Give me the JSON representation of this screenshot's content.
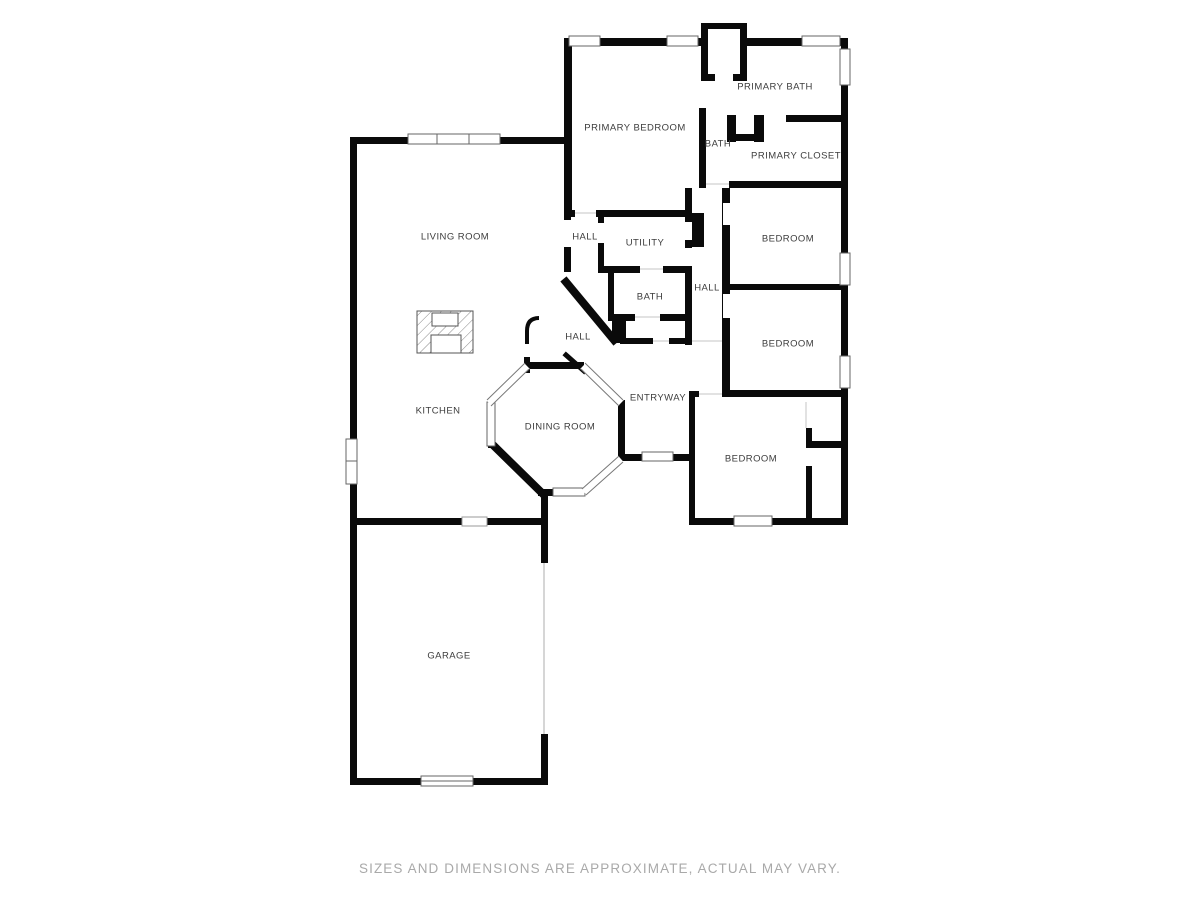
{
  "plan": {
    "type": "residential-floor-plan",
    "rooms": [
      {
        "id": "primary-bedroom",
        "label": "PRIMARY BEDROOM"
      },
      {
        "id": "primary-bath",
        "label": "PRIMARY BATH"
      },
      {
        "id": "bath-small",
        "label": "BATH"
      },
      {
        "id": "primary-closet",
        "label": "PRIMARY CLOSET"
      },
      {
        "id": "living-room",
        "label": "LIVING ROOM"
      },
      {
        "id": "hall-north",
        "label": "HALL"
      },
      {
        "id": "utility",
        "label": "UTILITY"
      },
      {
        "id": "bedroom-1",
        "label": "BEDROOM"
      },
      {
        "id": "bath-middle",
        "label": "BATH"
      },
      {
        "id": "hall-east",
        "label": "HALL"
      },
      {
        "id": "bedroom-2",
        "label": "BEDROOM"
      },
      {
        "id": "hall-center",
        "label": "HALL"
      },
      {
        "id": "entryway",
        "label": "ENTRYWAY"
      },
      {
        "id": "kitchen",
        "label": "KITCHEN"
      },
      {
        "id": "dining-room",
        "label": "DINING ROOM"
      },
      {
        "id": "bedroom-3",
        "label": "BEDROOM"
      },
      {
        "id": "garage",
        "label": "GARAGE"
      }
    ],
    "features": [
      {
        "id": "fireplace",
        "label": ""
      },
      {
        "id": "garage-door",
        "label": ""
      }
    ],
    "disclaimer": "SIZES AND DIMENSIONS ARE APPROXIMATE, ACTUAL MAY VARY.",
    "colors": {
      "background": "#ffffff",
      "walls": "#0a0a0a",
      "room_label": "#3d3d3d",
      "window_outline": "#666666",
      "disclaimer_text": "#a9a9a9"
    }
  }
}
